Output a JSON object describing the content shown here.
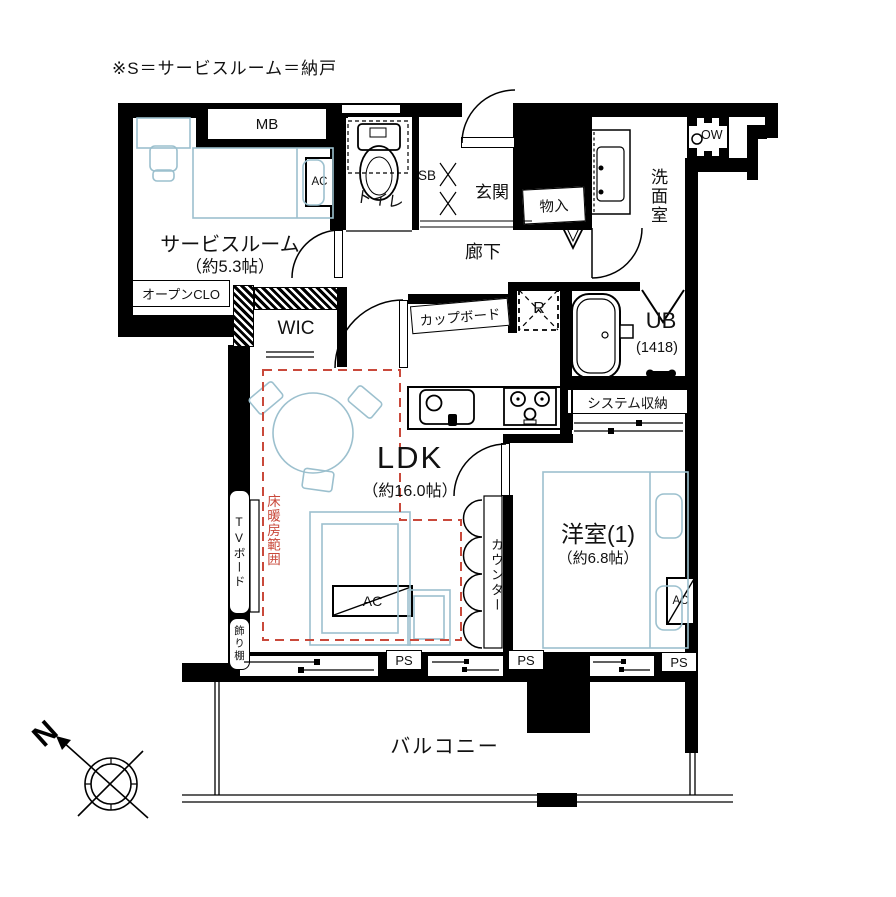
{
  "note": "※S＝サービスルーム＝納戸",
  "colors": {
    "wall": "#000000",
    "furniture_stroke": "#9cc0ce",
    "floor_heating_red": "#c9493b"
  },
  "labels": {
    "mb": "MB",
    "toilet": "トイレ",
    "shoe_box": "SB",
    "entrance": "玄関",
    "storage": "物入",
    "washroom": "洗面室",
    "washer": "OW",
    "service_room_name": "サービスルーム",
    "service_room_size": "（約5.3帖）",
    "open_closet": "オープンCLO",
    "wic": "WIC",
    "hallway": "廊下",
    "cupboard": "カップボード",
    "fridge": "R",
    "bath_name": "UB",
    "bath_size": "(1418)",
    "system_storage": "システム収納",
    "ldk_name": "LDK",
    "ldk_size": "（約16.0帖）",
    "western_room_name": "洋室(1)",
    "western_room_size": "（約6.8帖）",
    "counter": "カウンター",
    "tv_board": "TVボード",
    "display_shelf": "飾り棚",
    "floor_heating": "床暖房範囲",
    "balcony": "バルコニー",
    "ac": "AC",
    "ps": "PS",
    "north": "N"
  }
}
